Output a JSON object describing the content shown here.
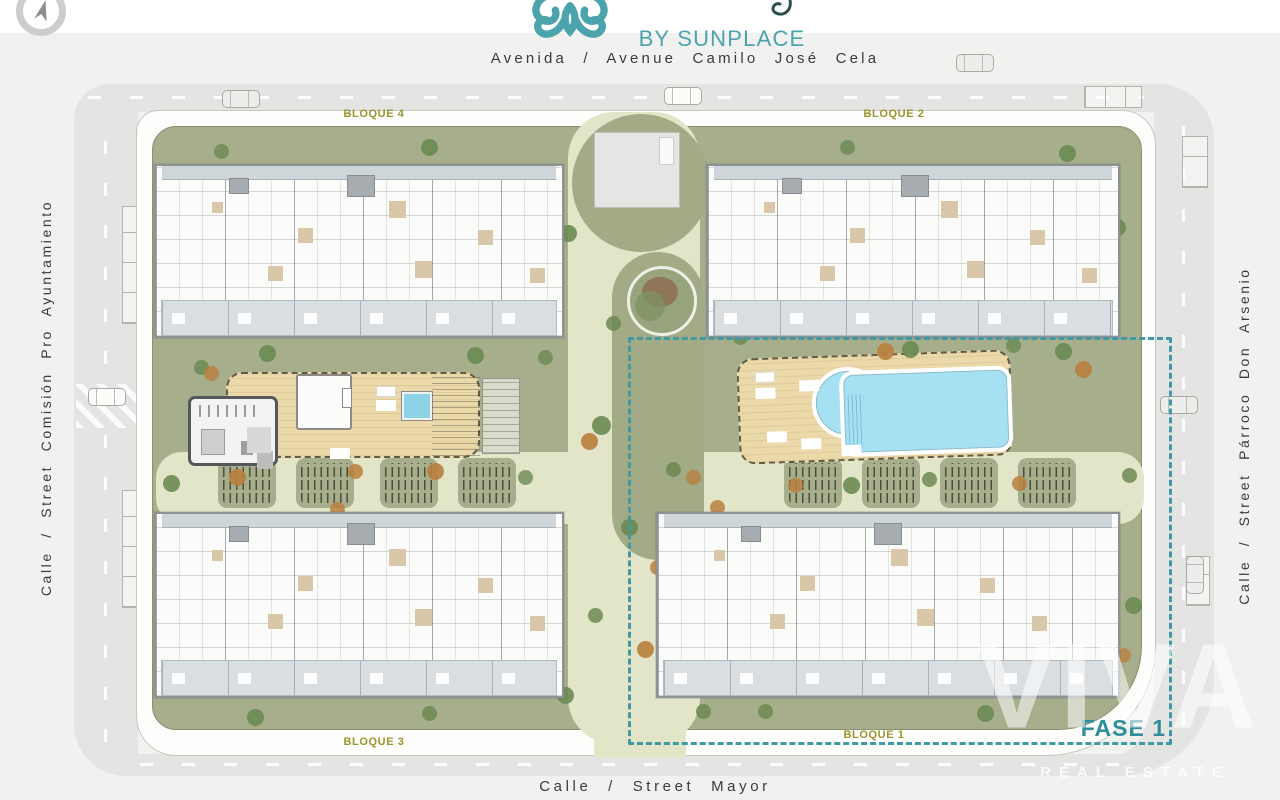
{
  "brand": {
    "name": "BY SUNPLACE",
    "logo": "sunplace-swirl"
  },
  "streets": {
    "top": "Avenida / Avenue Camilo José Cela",
    "left": "Calle / Street Comisión Pro Ayuntamiento",
    "right": "Calle / Street Párroco Don Arsenio",
    "bottom": "Calle / Street Mayor"
  },
  "blocks": {
    "b4": "BLOQUE 4",
    "b2": "BLOQUE 2",
    "b3": "BLOQUE 3",
    "b1": "BLOQUE 1"
  },
  "phase": {
    "label": "FASE 1"
  },
  "watermark": {
    "name": "VIVA",
    "tagline": "REAL ESTATE"
  },
  "colors": {
    "brand_teal": "#4aa3ad",
    "phase_teal": "#2f8e9a",
    "block_olive": "#9a952e",
    "lawn_green": "#a6ae8c",
    "path_sand": "#e2e5c8",
    "pool_blue": "#a5e1f2",
    "deck_wood": "#ecd9a9",
    "road_grey": "#e4e4e2"
  }
}
